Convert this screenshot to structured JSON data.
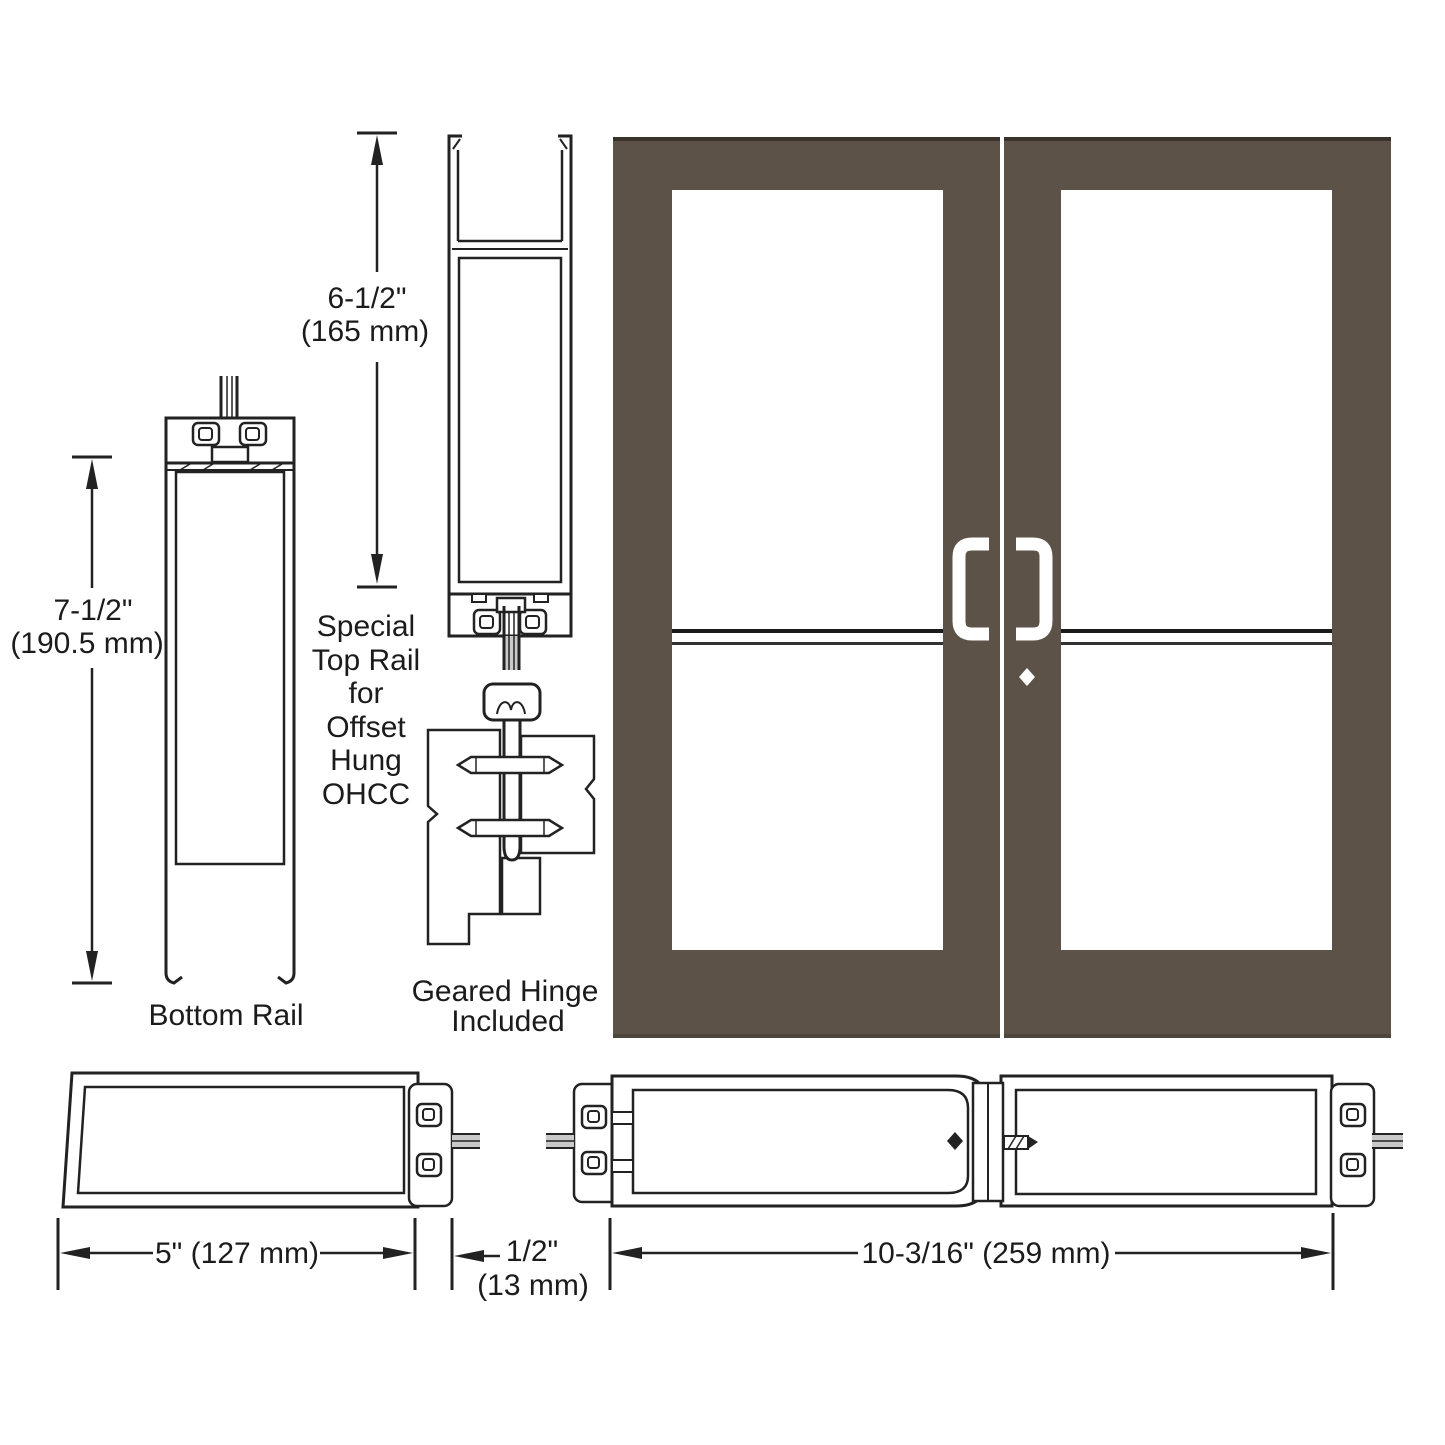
{
  "colors": {
    "background": "#ffffff",
    "door": "#5d5248",
    "door_edge": "#3a332b",
    "line": "#222222",
    "handle": "#ffffff",
    "rod_band": "#c9c9c9"
  },
  "labels": {
    "bottom_rail": "Bottom Rail",
    "special_top_rail": [
      "Special",
      "Top Rail",
      "for",
      "Offset",
      "Hung",
      "OHCC"
    ],
    "geared_hinge": [
      "Geared Hinge",
      "Included"
    ]
  },
  "dimensions": {
    "top_rail_height": {
      "value_in": "6-1/2\"",
      "value_mm": "(165 mm)"
    },
    "bottom_rail_height": {
      "value_in": "7-1/2\"",
      "value_mm": "(190.5 mm)"
    },
    "stile_width": {
      "label": "5\" (127 mm)"
    },
    "glass_gap": {
      "value_in": "1/2\"",
      "value_mm": "(13 mm)"
    },
    "pair_stile_width": {
      "label": "10-3/16\" (259 mm)"
    }
  }
}
